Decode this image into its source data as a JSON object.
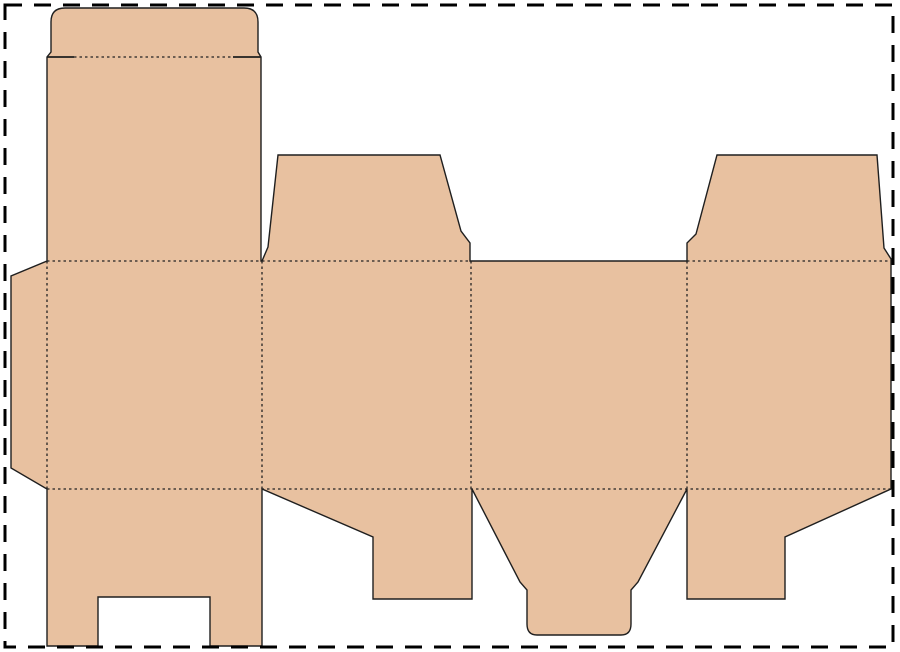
{
  "canvas": {
    "width": 900,
    "height": 652,
    "background_color": "#ffffff",
    "border": {
      "x": 5,
      "y": 5,
      "width": 888,
      "height": 642,
      "color": "#000000",
      "stroke_width": 3,
      "dash_pattern": "17 12"
    }
  },
  "dieline": {
    "fill_color": "#e8c1a0",
    "cut_line_color": "#1f1f1f",
    "cut_stroke_width": 1.4,
    "fold_line_color": "#222222",
    "fold_stroke_width": 1.3,
    "fold_dash_pattern": "2.5 3",
    "outline_path": "M 51 22 Q 51 8 65 8 L 244 8 Q 258 8 258 22 L 258 52 L 261 57 L 261 261 L 262 261 L 268 247 L 278 155 L 440 155 L 461 231 L 470 243 L 470 261 L 687 261 L 687 243 L 696 234 L 717 155 L 877 155 L 884 248 L 891 259 L 891 489 L 785 537 L 785 599 L 687 599 L 687 489 L 638 582 L 631 590 L 631 624 Q 631 635 621 635 L 537 635 Q 527 635 527 624 L 527 590 L 520 582 L 472 489 L 472 599 L 373 599 L 373 537 L 262 489 L 262 646 L 210 646 L 210 597 L 98 597 L 98 646 L 47 646 L 47 489 L 11 468 L 11 276 L 47 261 L 47 57 L 51 52 Z",
    "slit_cuts": [
      {
        "name": "tuck-flap-left-slit",
        "x1": 47,
        "y1": 57,
        "x2": 74,
        "y2": 57
      },
      {
        "name": "tuck-flap-right-slit",
        "x1": 233,
        "y1": 57,
        "x2": 261,
        "y2": 57
      }
    ],
    "fold_lines": [
      {
        "name": "tuck-flap-fold",
        "x1": 74,
        "y1": 57,
        "x2": 233,
        "y2": 57
      },
      {
        "name": "lid-panel-fold",
        "x1": 47,
        "y1": 261,
        "x2": 261,
        "y2": 261
      },
      {
        "name": "dust-flap-2-fold",
        "x1": 262,
        "y1": 261,
        "x2": 470,
        "y2": 261
      },
      {
        "name": "dust-flap-4-fold",
        "x1": 687,
        "y1": 261,
        "x2": 891,
        "y2": 261
      },
      {
        "name": "bottom-flaps-fold",
        "x1": 47,
        "y1": 489,
        "x2": 891,
        "y2": 489
      },
      {
        "name": "glue-flap-fold",
        "x1": 47,
        "y1": 261,
        "x2": 47,
        "y2": 489
      },
      {
        "name": "panel-1-2-fold",
        "x1": 262,
        "y1": 261,
        "x2": 262,
        "y2": 489
      },
      {
        "name": "panel-2-3-fold",
        "x1": 471,
        "y1": 261,
        "x2": 471,
        "y2": 489
      },
      {
        "name": "panel-3-4-fold",
        "x1": 687,
        "y1": 261,
        "x2": 687,
        "y2": 489
      }
    ]
  }
}
